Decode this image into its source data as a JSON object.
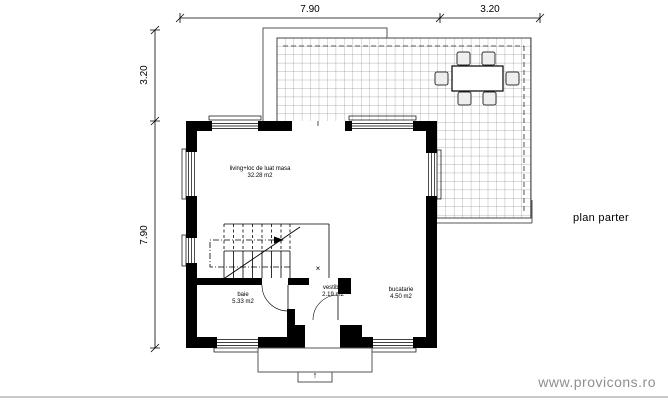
{
  "title": "plan parter",
  "watermark": "www.provicons.ro",
  "dimensions": {
    "top": [
      {
        "label": "7.90"
      },
      {
        "label": "3.20"
      }
    ],
    "left": [
      {
        "label": "3.20"
      },
      {
        "label": "7.90"
      }
    ]
  },
  "rooms": {
    "living": {
      "name": "living+loc de luat masa",
      "area": "32.28 m2"
    },
    "baie": {
      "name": "baie",
      "area": "5.33 m2"
    },
    "vestibul": {
      "name": "vestibul",
      "area": "2.19 m2"
    },
    "bucatarie": {
      "name": "bucatarie",
      "area": "4.50 m2"
    }
  },
  "markers": {
    "cross": "×",
    "entry_arrow": "↑"
  },
  "colors": {
    "wall": "#000000",
    "grid_line": "#9a9a9a",
    "watermark": "#8f8f8f"
  }
}
